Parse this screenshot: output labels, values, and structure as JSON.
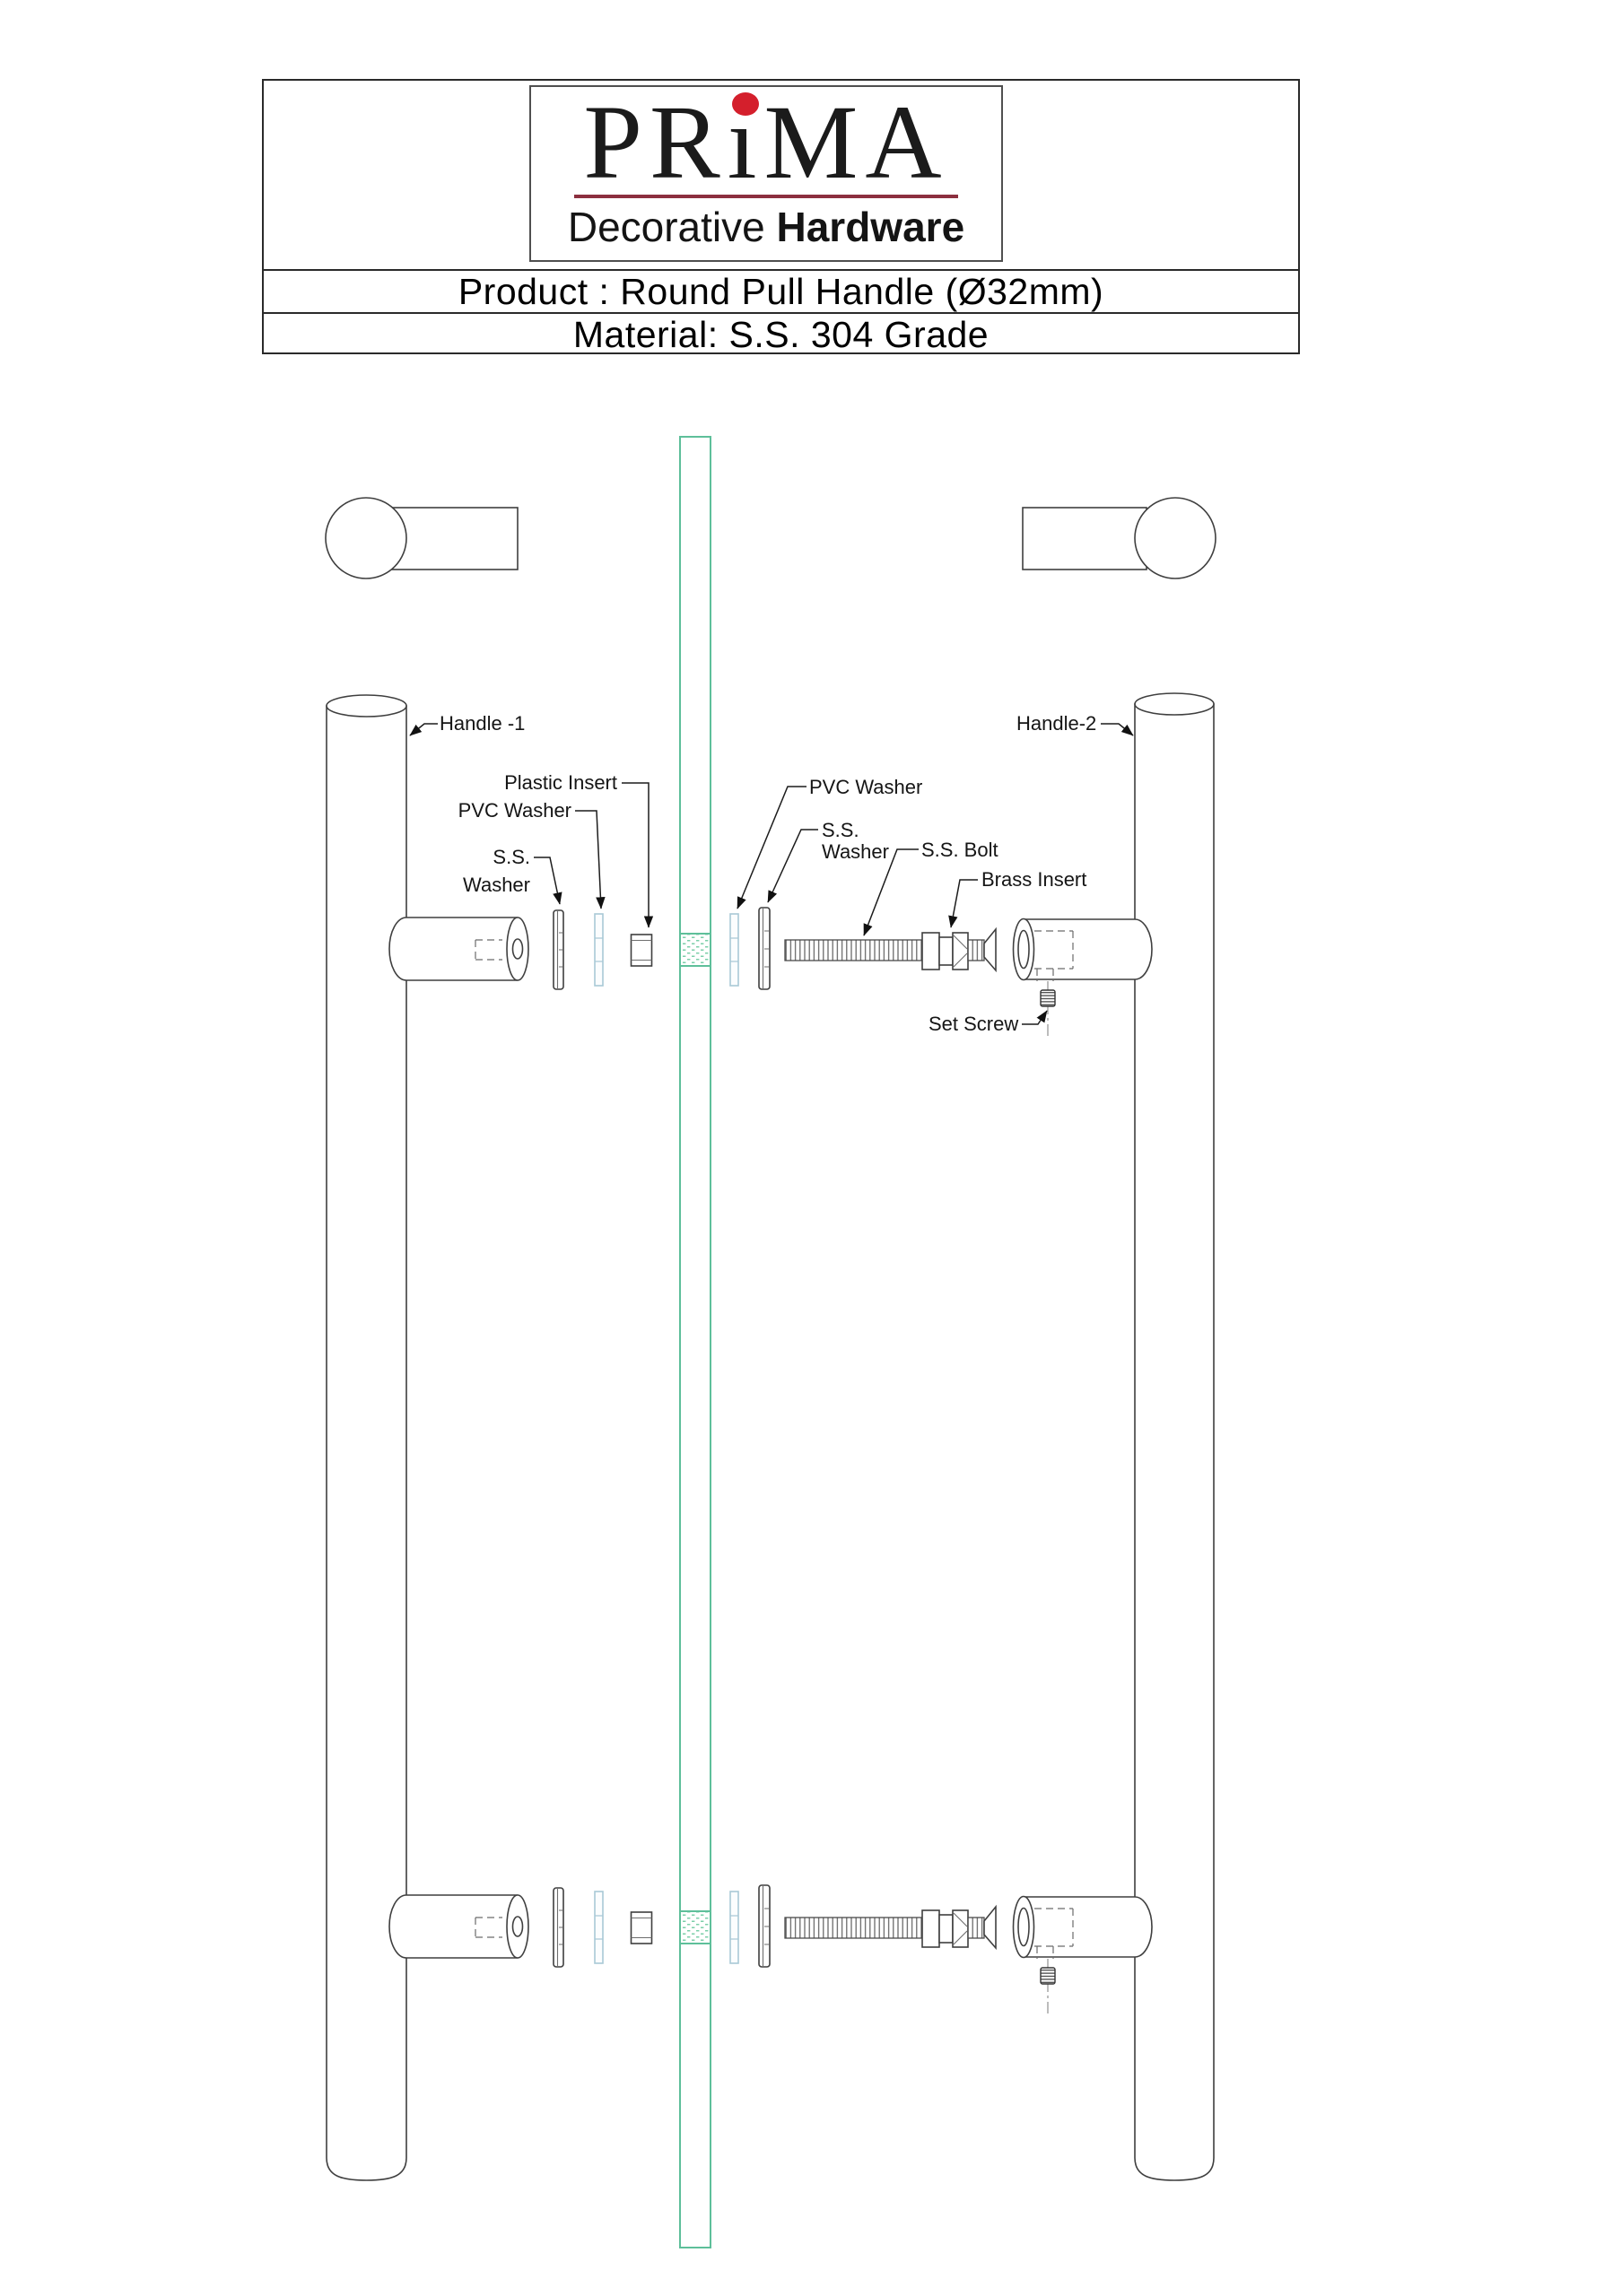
{
  "header": {
    "brand": {
      "part1": "PR",
      "part2": "ı",
      "part3": "MA",
      "tagline_light": "Decorative",
      "tagline_bold": "Hardware"
    },
    "rows": {
      "product": "Product : Round Pull Handle (Ø32mm)",
      "material": "Material: S.S. 304 Grade"
    }
  },
  "diagram": {
    "labels": {
      "handle1": "Handle -1",
      "handle2": "Handle-2",
      "plastic_insert": "Plastic Insert",
      "pvc_washer_left": "PVC Washer",
      "ss_washer_left_line1": "S.S.",
      "ss_washer_left_line2": "Washer",
      "pvc_washer_right": "PVC Washer",
      "ss_washer_right_line1": "S.S.",
      "ss_washer_right_line2": "Washer",
      "ss_bolt": "S.S. Bolt",
      "brass_insert": "Brass Insert",
      "set_screw": "Set Screw"
    },
    "colors": {
      "glass_green": "#5ebf9a",
      "pvc_blue": "#a9c9d6",
      "outline_gray": "#3f3f3f",
      "logo_red": "#d41f2c",
      "logo_maroon": "#8c2f3f"
    }
  }
}
